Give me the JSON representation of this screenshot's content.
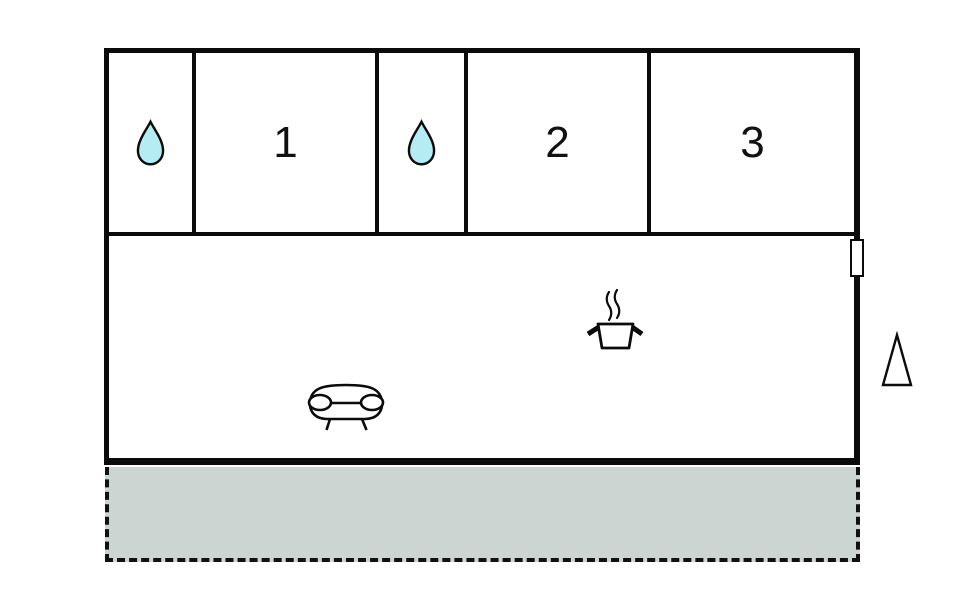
{
  "title": "apartment-floor-plan",
  "colors": {
    "wall": "#0b0b0b",
    "drop_fill": "#b5ecf3",
    "terrace_fill": "#cdd5d2",
    "background": "#ffffff"
  },
  "rooms": [
    {
      "name": "bath-1",
      "label": "",
      "icon": "water-drop-icon"
    },
    {
      "name": "room-1",
      "label": "1",
      "icon": ""
    },
    {
      "name": "bath-2",
      "label": "",
      "icon": "water-drop-icon"
    },
    {
      "name": "room-2",
      "label": "2",
      "icon": ""
    },
    {
      "name": "room-3",
      "label": "3",
      "icon": ""
    }
  ],
  "living_area": {
    "icons": [
      "stove-pot-icon",
      "sofa-icon"
    ]
  },
  "exterior": {
    "markers": [
      "window-marker",
      "entry-triangle-marker"
    ],
    "terrace": "terrace"
  }
}
